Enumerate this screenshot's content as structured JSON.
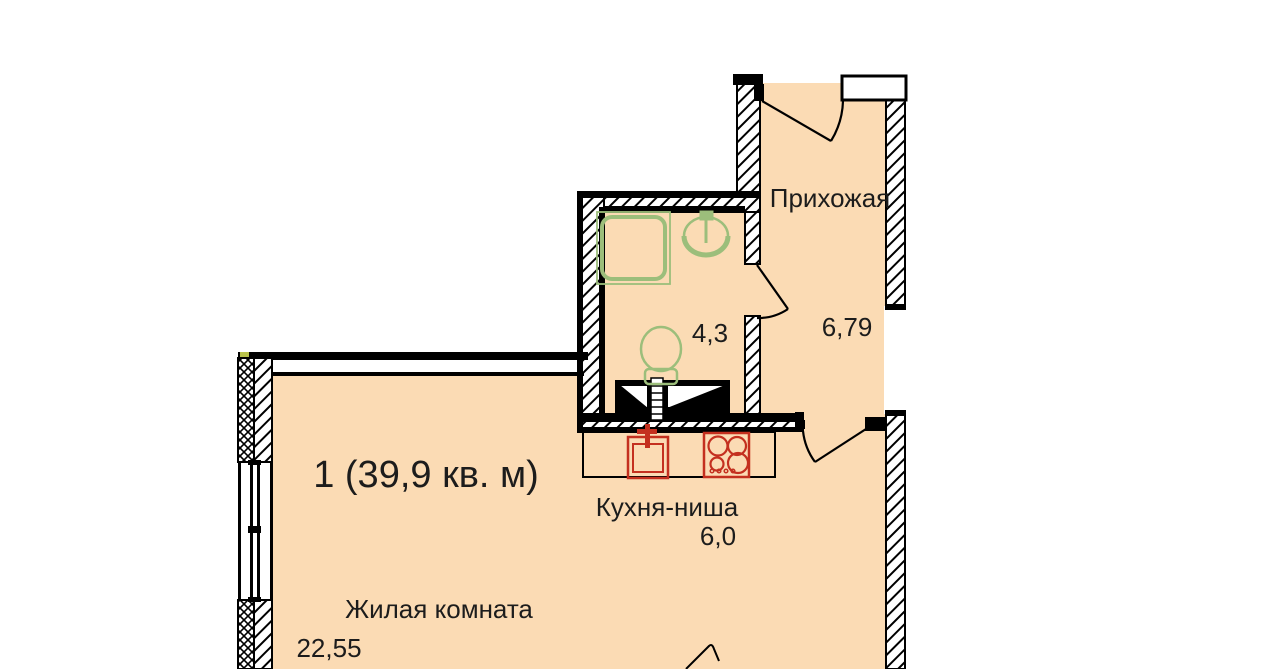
{
  "plan": {
    "title": "1 (39,9 кв. м)",
    "rooms": [
      {
        "id": "hallway",
        "name": "Прихожая",
        "area": "6,79"
      },
      {
        "id": "bathroom",
        "area": "4,3"
      },
      {
        "id": "kitchen",
        "name": "Кухня-ниша",
        "area": "6,0"
      },
      {
        "id": "living",
        "name": "Жилая комната",
        "area": "22,55"
      }
    ],
    "colors": {
      "floor": "#FBDBB4",
      "wall": "#000000",
      "fixture_green": "#9CBE7B",
      "fixture_red": "#C4301F",
      "corner_mark": "#B9C24B"
    },
    "fixtures": [
      "shower",
      "bathroom-sink",
      "toilet",
      "kitchen-sink",
      "stove",
      "ventilation-shaft",
      "entrance-door",
      "bathroom-door",
      "living-room-door",
      "window"
    ]
  }
}
